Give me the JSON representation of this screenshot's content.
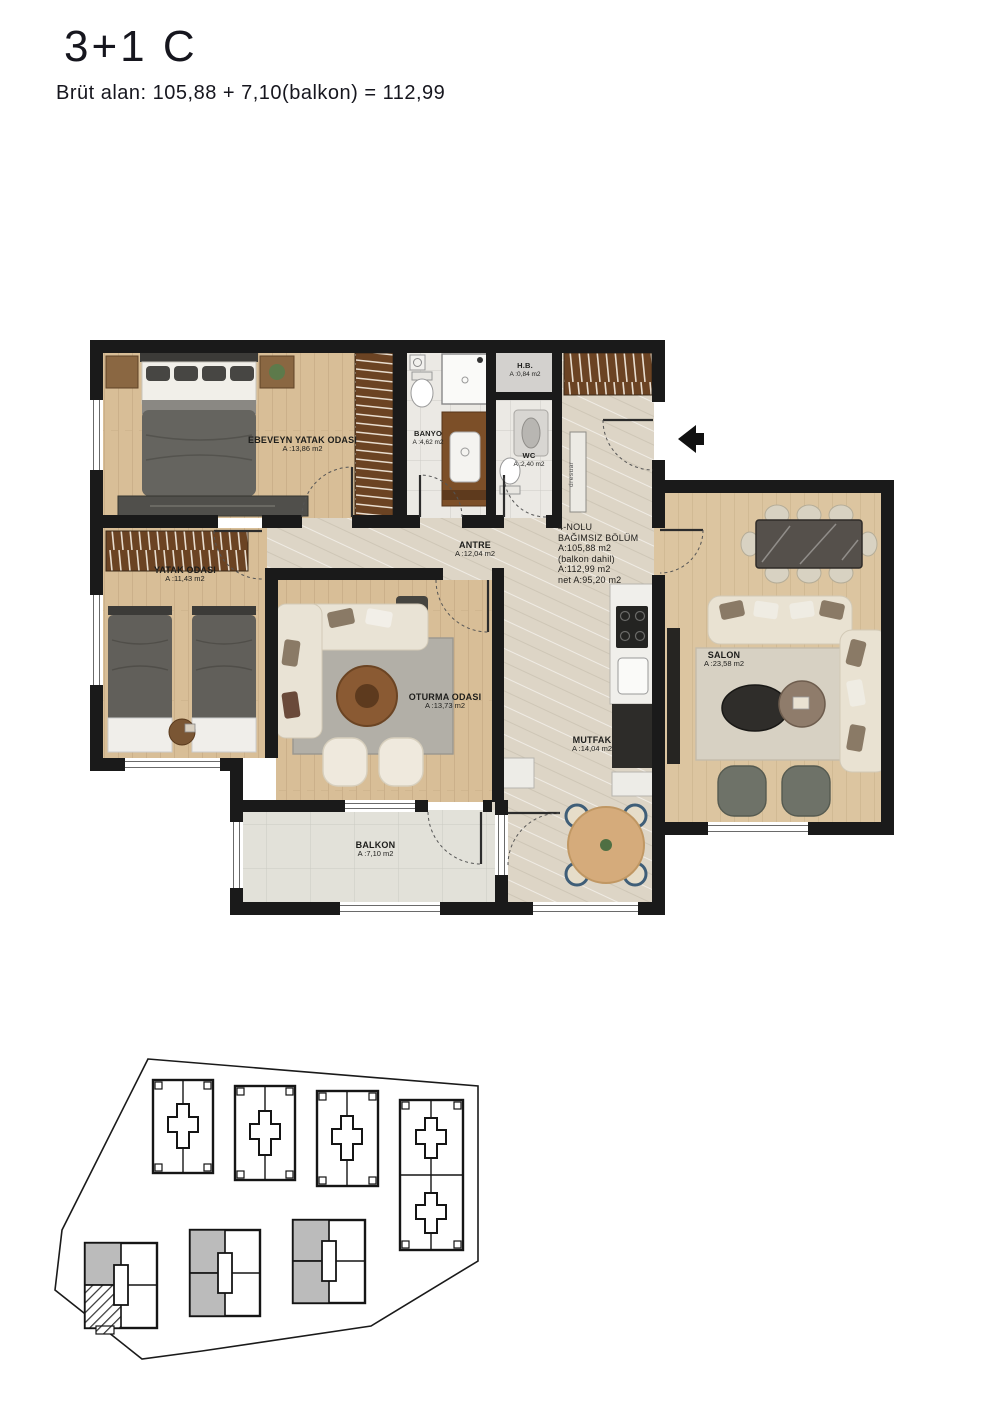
{
  "header": {
    "title": "3+1 C",
    "subtitle": "Brüt alan: 105,88 + 7,10(balkon) = 112,99"
  },
  "floor_plan": {
    "rooms": [
      {
        "name": "EBEVEYN YATAK ODASI",
        "area": "A :13,86 m2"
      },
      {
        "name": "YATAK ODASI",
        "area": "A :11,43 m2"
      },
      {
        "name": "BANYO",
        "area": "A :4,62 m2"
      },
      {
        "name": "WC",
        "area": "A :2,40 m2"
      },
      {
        "name": "H.B.",
        "area": "A :0,84 m2"
      },
      {
        "name": "ANTRE",
        "area": "A :12,04 m2"
      },
      {
        "name": "OTURMA ODASI",
        "area": "A :13,73 m2"
      },
      {
        "name": "MUTFAK",
        "area": "A :14,04 m2"
      },
      {
        "name": "SALON",
        "area": "A :23,58 m2"
      },
      {
        "name": "BALKON",
        "area": "A :7,10 m2"
      }
    ],
    "unit_info": {
      "lines": [
        "4-NOLU",
        "BAĞIMSIZ BÖLÜM",
        "A:105,88 m2",
        "(balkon dahil)",
        "A:112,99 m2",
        "net A:95,20 m2"
      ]
    },
    "dresuar_label": "dresuar"
  },
  "colors": {
    "wall": "#1a1a1a",
    "wood_floor": "#d8be97",
    "salon_wood_floor": "#dcc5a0",
    "marble_floor": "#ddd5c6",
    "tile_floor": "#ebe9e4",
    "balcony_floor": "#e2e1d9",
    "site_unit_gray": "#bbbbbb"
  }
}
